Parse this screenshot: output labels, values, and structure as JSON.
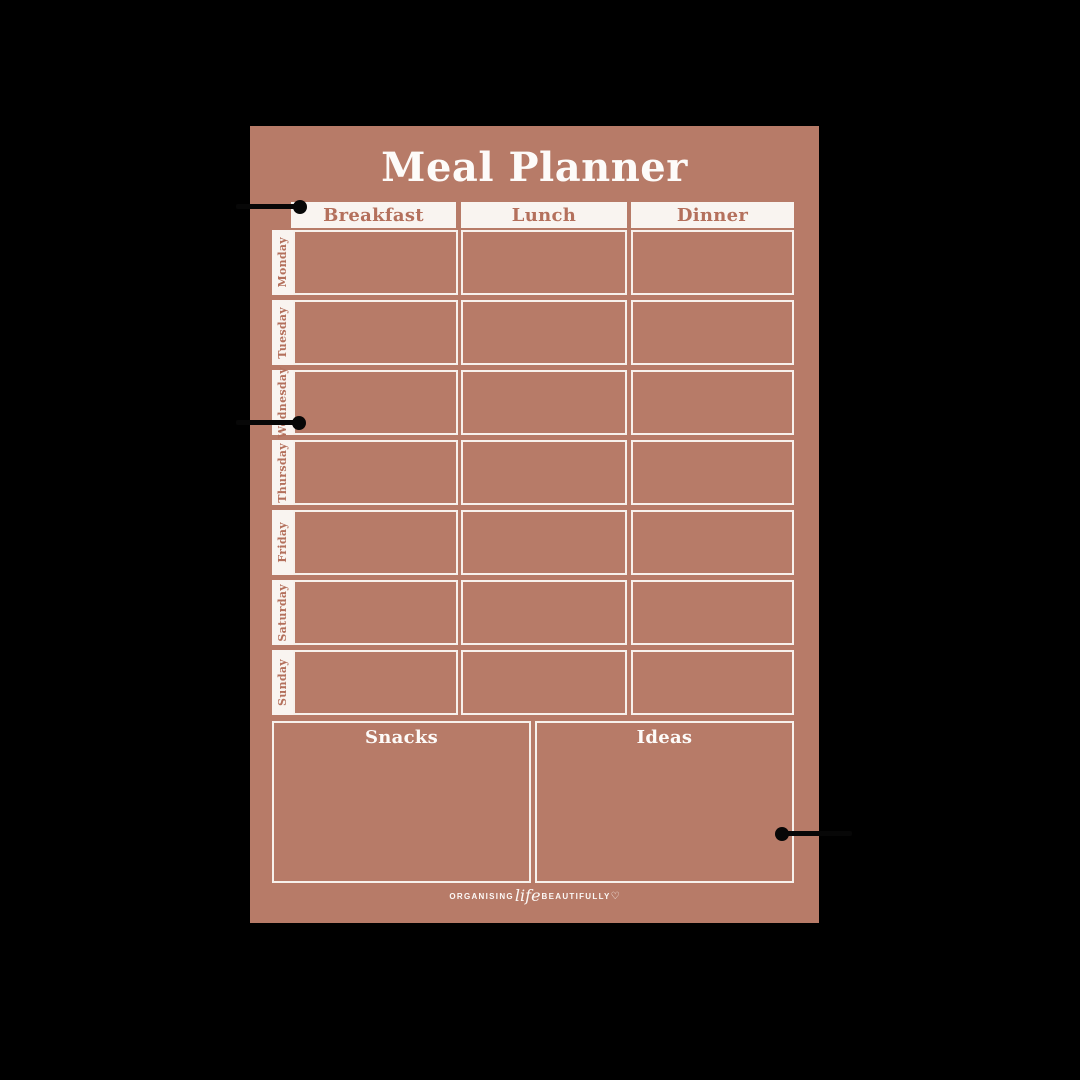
{
  "planner": {
    "title": "Meal Planner",
    "columns": [
      "Breakfast",
      "Lunch",
      "Dinner"
    ],
    "days": [
      "Monday",
      "Tuesday",
      "Wednesday",
      "Thursday",
      "Friday",
      "Saturday",
      "Sunday"
    ],
    "sections": {
      "snacks": "Snacks",
      "ideas": "Ideas"
    },
    "footer": {
      "pre": "ORGANISING",
      "script": "life",
      "post": "BEAUTIFULLY",
      "heart": "♡"
    },
    "colors": {
      "canvas_background": "#000000",
      "paper": "#b77b68",
      "accent_text": "#b4705c",
      "paper_white": "#f9f4f0",
      "border_white": "#f7f1ec",
      "callout_black": "#070707"
    }
  }
}
